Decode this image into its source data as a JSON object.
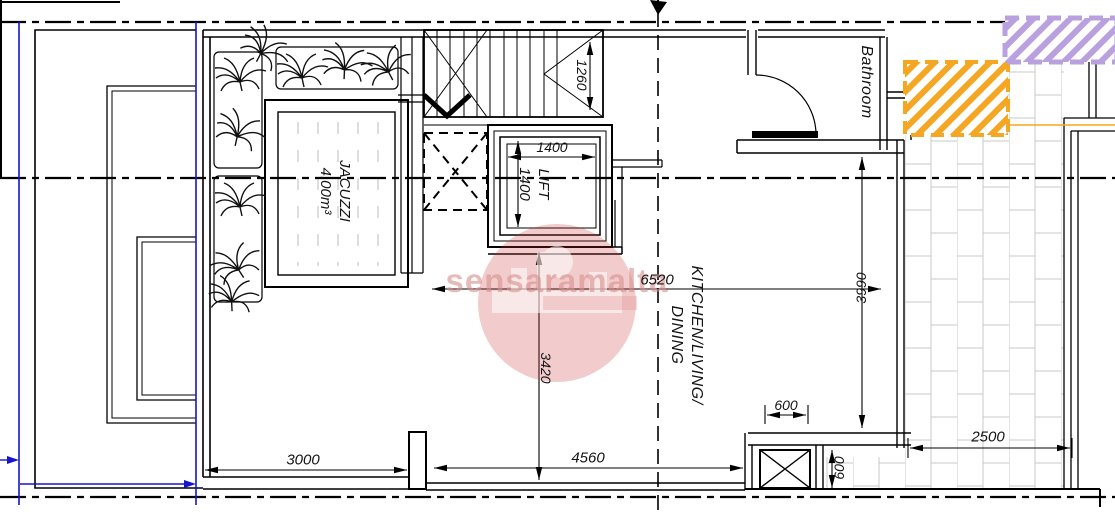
{
  "plan": {
    "watermark_text": "sensaramalta",
    "labels": {
      "jacuzzi_line1": "JACUZZI",
      "jacuzzi_line2": "4.00m³",
      "lift_line1": "LIFT",
      "lift_line2": "1400",
      "bathroom": "Bathroom",
      "kitchen_line1": "KITCHEN/LIVING/",
      "kitchen_line2": "DINING"
    },
    "dimensions": {
      "stairs_width": "1260",
      "lift_width": "1400",
      "jacuzzi_terrace_width": "3000",
      "living_width": "4560",
      "living_length": "6520",
      "living_depth": "3420",
      "terrace_depth": "3990",
      "duct_width": "600",
      "duct_depth": "600",
      "terrace_width": "2500"
    },
    "colors": {
      "highlight_orange": "#F5A623",
      "highlight_purple": "#B9A1E0",
      "boundary_blue": "#1515CF",
      "watermark_pink": "#D98F8F"
    }
  }
}
